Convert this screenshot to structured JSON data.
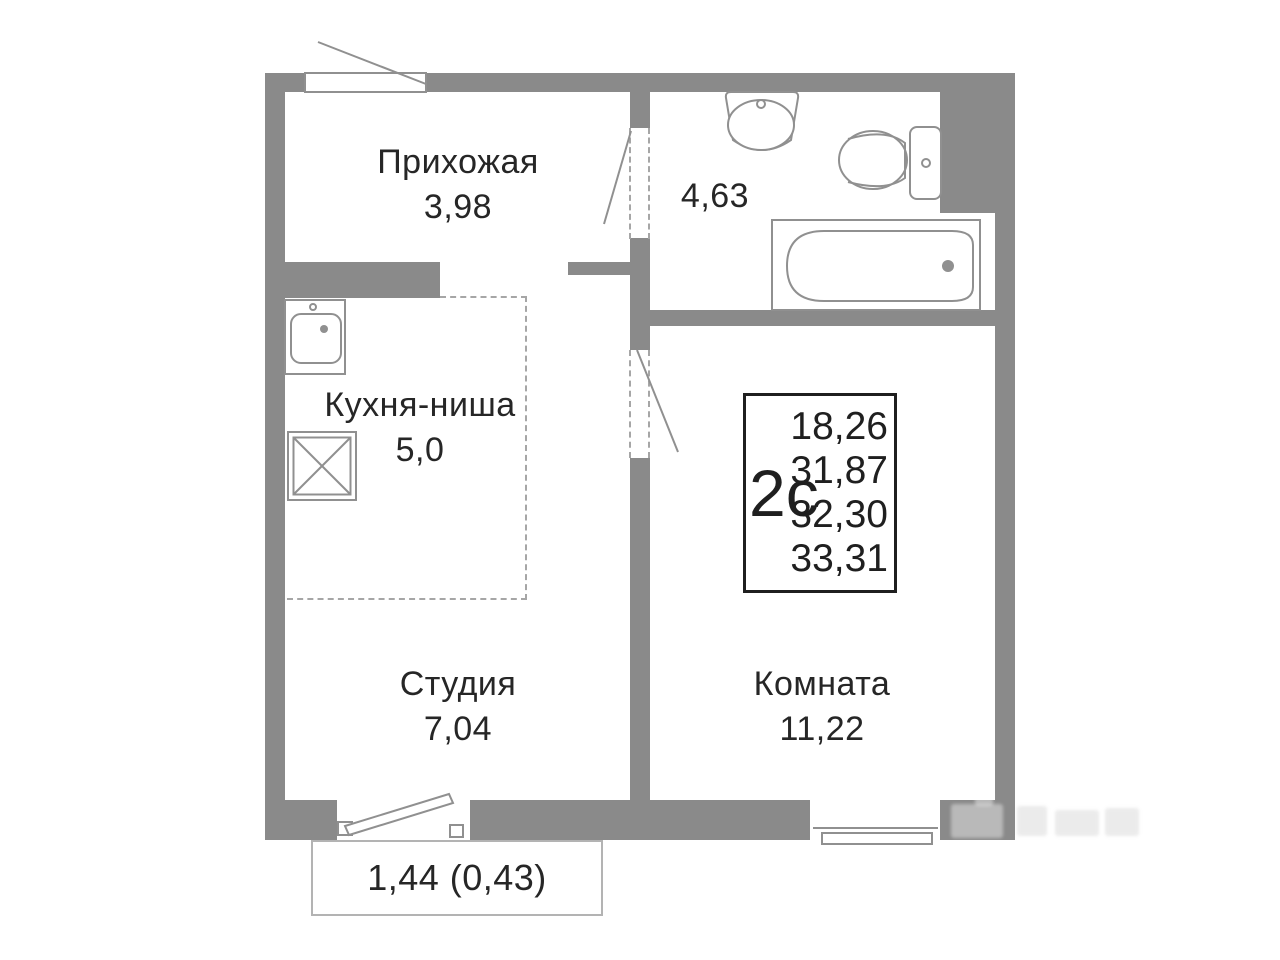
{
  "colors": {
    "wall": "#8a8a8a",
    "fixture_line": "#909090",
    "dash": "#a6a6a6",
    "text": "#262626",
    "info_border": "#1f1f1f",
    "balcony_border": "#b3b3b3"
  },
  "rooms": {
    "hallway": {
      "label": "Прихожая",
      "area": "3,98"
    },
    "bathroom": {
      "area": "4,63"
    },
    "kitchen": {
      "label": "Кухня-ниша",
      "area": "5,0"
    },
    "studio": {
      "label": "Студия",
      "area": "7,04"
    },
    "living_room": {
      "label": "Комната",
      "area": "11,22"
    }
  },
  "info_box": {
    "type": "2с",
    "values": [
      "18,26",
      "31,87",
      "32,30",
      "33,31"
    ]
  },
  "balcony": {
    "label": "1,44 (0,43)"
  },
  "fixture_icons": [
    "bath-sink-icon",
    "toilet-icon",
    "bathtub-icon",
    "kitchen-sink-icon",
    "stove-icon"
  ]
}
